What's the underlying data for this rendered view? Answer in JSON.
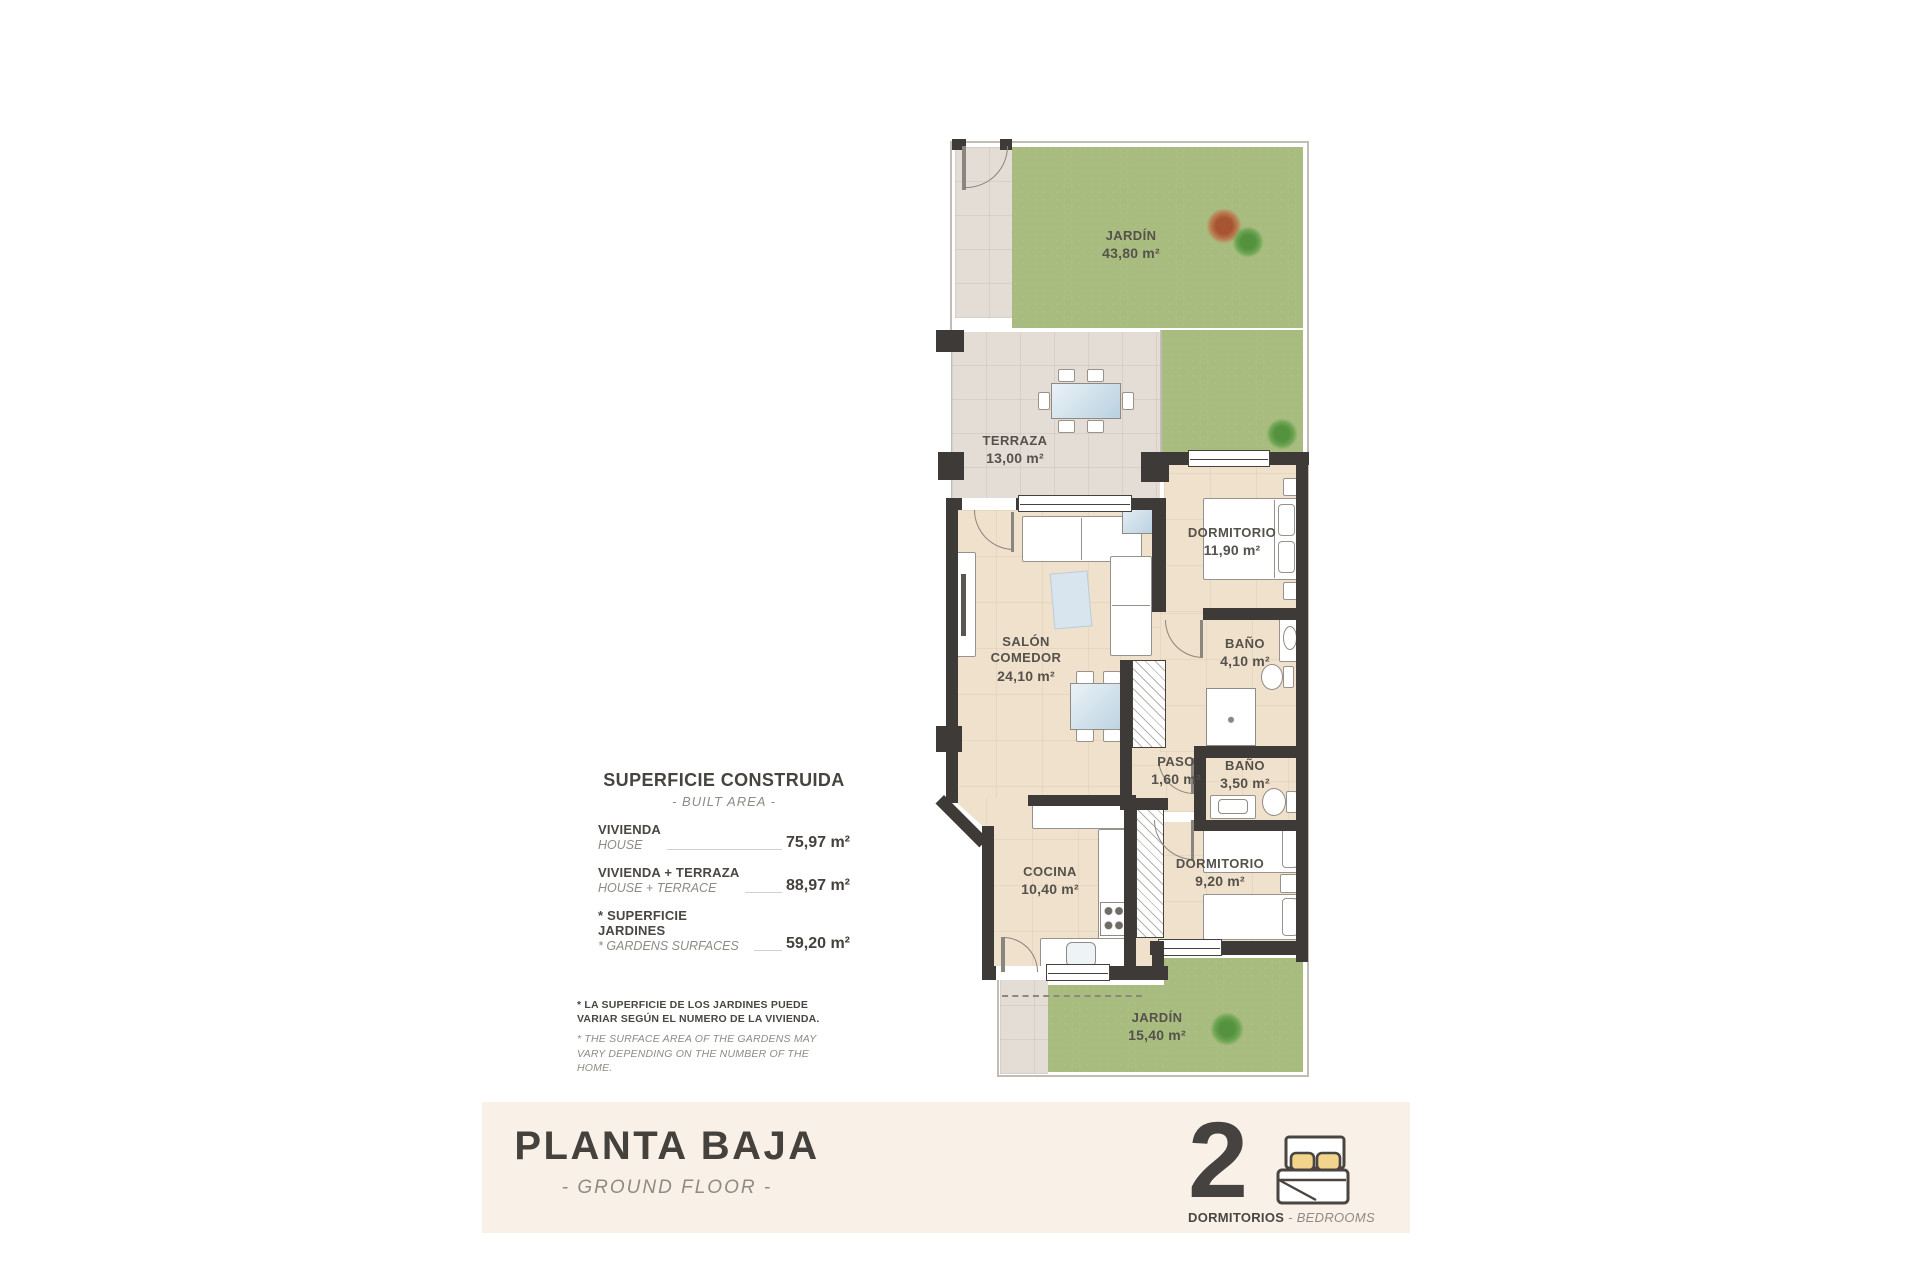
{
  "plan": {
    "rooms": {
      "jardin_top": {
        "name": "JARDÍN",
        "area": "43,80 m²"
      },
      "terraza": {
        "name": "TERRAZA",
        "area": "13,00 m²"
      },
      "salon": {
        "name": "SALÓN COMEDOR",
        "area": "24,10 m²"
      },
      "dormitorio1": {
        "name": "DORMITORIO",
        "area": "11,90 m²"
      },
      "bano1": {
        "name": "BAÑO",
        "area": "4,10 m²"
      },
      "paso": {
        "name": "PASO",
        "area": "1,60 m²"
      },
      "bano2": {
        "name": "BAÑO",
        "area": "3,50 m²"
      },
      "cocina": {
        "name": "COCINA",
        "area": "10,40 m²"
      },
      "dormitorio2": {
        "name": "DORMITORIO",
        "area": "9,20 m²"
      },
      "jardin_bottom": {
        "name": "JARDÍN",
        "area": "15,40 m²"
      }
    }
  },
  "built_area": {
    "title": "SUPERFICIE CONSTRUIDA",
    "subtitle": "- BUILT AREA -",
    "rows": [
      {
        "label_es": "VIVIENDA",
        "label_en": "HOUSE",
        "value": "75,97 m²"
      },
      {
        "label_es": "VIVIENDA + TERRAZA",
        "label_en": "HOUSE + TERRACE",
        "value": "88,97 m²"
      },
      {
        "label_es": "* SUPERFICIE JARDINES",
        "label_en": "* GARDENS SURFACES",
        "value": "59,20 m²"
      }
    ]
  },
  "footnote": {
    "es": "* LA SUPERFICIE DE LOS JARDINES PUEDE VARIAR SEGÚN EL NUMERO DE LA VIVIENDA.",
    "en": "* THE SURFACE AREA OF THE GARDENS MAY VARY DEPENDING ON THE NUMBER OF THE HOME."
  },
  "footer": {
    "title": "PLANTA BAJA",
    "subtitle": "- GROUND FLOOR -",
    "bedrooms_count": "2",
    "bedrooms_label_es": "DORMITORIOS",
    "bedrooms_separator": " - ",
    "bedrooms_label_en": "BEDROOMS"
  },
  "icons": {
    "footer_bed": "double-bed-icon",
    "garden_plants": [
      "bush-icon",
      "plant-icon"
    ]
  },
  "colors": {
    "wall": "#3e3a37",
    "floor": "#efe1cb",
    "terrace": "#e4ddd6",
    "garden": "#a9bc80",
    "footer_band": "#f9f1e8",
    "text_dark": "#4a4641",
    "text_gray": "#8f8a84",
    "pillow_yellow": "#f2d48c"
  }
}
